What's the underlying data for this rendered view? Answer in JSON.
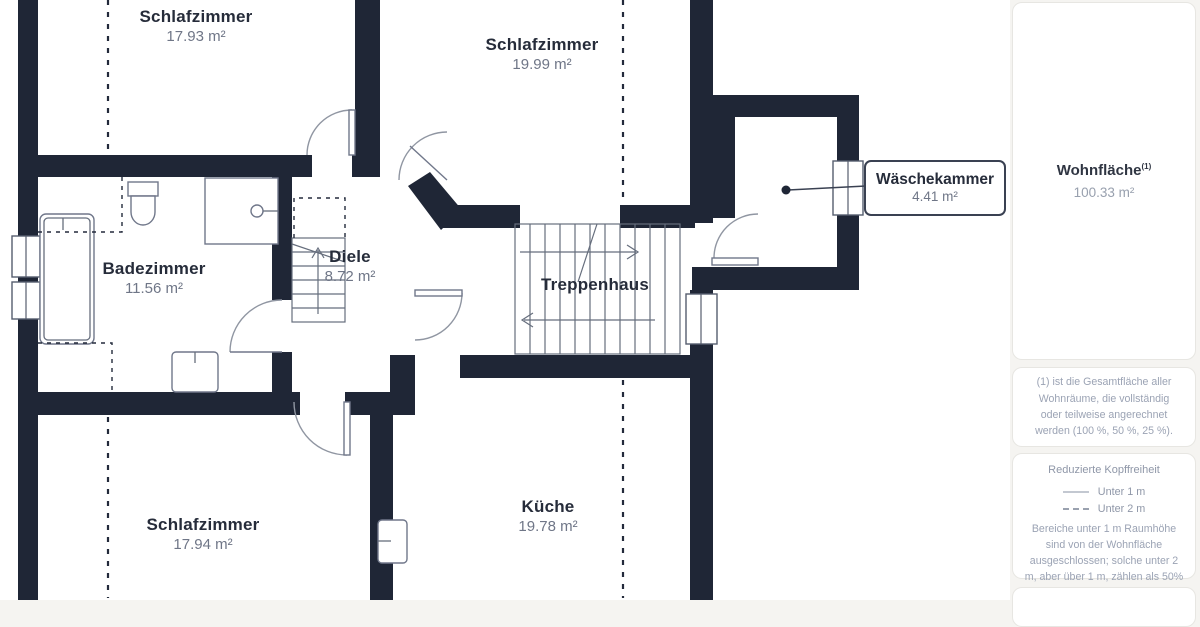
{
  "plan": {
    "rooms": [
      {
        "name": "Schlafzimmer",
        "area": "17.93 m²"
      },
      {
        "name": "Schlafzimmer",
        "area": "19.99 m²"
      },
      {
        "name": "Badezimmer",
        "area": "11.56 m²"
      },
      {
        "name": "Diele",
        "area": "8.72 m²"
      },
      {
        "name": "Treppenhaus"
      },
      {
        "name": "Wäschekammer",
        "area": "4.41 m²"
      },
      {
        "name": "Schlafzimmer",
        "area": "17.94 m²"
      },
      {
        "name": "Küche",
        "area": "19.78 m²"
      }
    ]
  },
  "sidebar": {
    "living_area": {
      "label": "Wohnfläche",
      "superscript": "(1)",
      "value": "100.33 m²"
    },
    "footnote": "(1) ist die Gesamtfläche aller Wohnräume, die vollständig oder teilweise angerechnet werden (100 %, 50 %, 25 %).",
    "legend": {
      "title": "Reduzierte Kopffreiheit",
      "items": [
        {
          "style": "solid",
          "label": "Unter 1 m"
        },
        {
          "style": "dashed",
          "label": "Unter 2 m"
        }
      ],
      "note": "Bereiche unter 1 m Raumhöhe sind von der Wohnfläche ausgeschlossen; solche unter 2 m, aber über 1 m, zählen als 50% der Wohnfläche"
    }
  },
  "colors": {
    "wall": "#1f2636",
    "card_border": "#e7e6e2",
    "muted_text": "#9ba3b4"
  }
}
